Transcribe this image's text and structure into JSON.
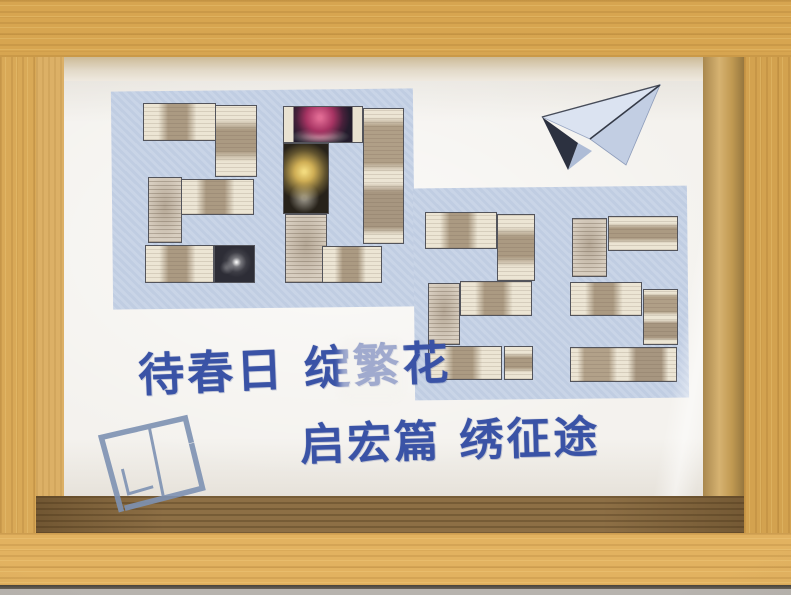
{
  "collage": {
    "year": "2025",
    "digits": [
      {
        "char": "2",
        "x": 79,
        "y": 22,
        "w": 114,
        "h": 180,
        "blocks": [
          {
            "x": 0,
            "y": 0,
            "w": 64,
            "h": 21,
            "t": "pv"
          },
          {
            "x": 63,
            "y": 1,
            "w": 37,
            "h": 40,
            "t": "ph"
          },
          {
            "x": 33,
            "y": 42,
            "w": 64,
            "h": 20,
            "t": "pv"
          },
          {
            "x": 4,
            "y": 41,
            "w": 30,
            "h": 37,
            "t": "ptxt"
          },
          {
            "x": 2,
            "y": 79,
            "w": 60,
            "h": 21,
            "t": "pv"
          },
          {
            "x": 62,
            "y": 79,
            "w": 36,
            "h": 21,
            "t": "fww"
          }
        ]
      },
      {
        "char": "0",
        "x": 219,
        "y": 25,
        "w": 121,
        "h": 177,
        "blocks": [
          {
            "x": 0,
            "y": 0,
            "w": 66,
            "h": 21,
            "t": "fwp"
          },
          {
            "x": 66,
            "y": 1,
            "w": 34,
            "h": 77,
            "t": "ph2"
          },
          {
            "x": 0,
            "y": 21,
            "w": 38,
            "h": 40,
            "t": "fwg"
          },
          {
            "x": 2,
            "y": 61,
            "w": 34,
            "h": 39,
            "t": "ptxt"
          },
          {
            "x": 32,
            "y": 79,
            "w": 50,
            "h": 21,
            "t": "pv"
          }
        ]
      },
      {
        "char": "2",
        "x": 361,
        "y": 131,
        "w": 110,
        "h": 168,
        "blocks": [
          {
            "x": 0,
            "y": 0,
            "w": 65,
            "h": 22,
            "t": "pv"
          },
          {
            "x": 65,
            "y": 1,
            "w": 35,
            "h": 40,
            "t": "ph"
          },
          {
            "x": 32,
            "y": 41,
            "w": 65,
            "h": 21,
            "t": "pv"
          },
          {
            "x": 3,
            "y": 42,
            "w": 29,
            "h": 37,
            "t": "ptxt"
          },
          {
            "x": 3,
            "y": 80,
            "w": 67,
            "h": 20,
            "t": "pv"
          },
          {
            "x": 72,
            "y": 80,
            "w": 26,
            "h": 20,
            "t": "ph"
          }
        ]
      },
      {
        "char": "5",
        "x": 506,
        "y": 135,
        "w": 108,
        "h": 166,
        "blocks": [
          {
            "x": 2,
            "y": 1,
            "w": 32,
            "h": 36,
            "t": "ptxt"
          },
          {
            "x": 35,
            "y": 0,
            "w": 65,
            "h": 21,
            "t": "ph"
          },
          {
            "x": 0,
            "y": 40,
            "w": 67,
            "h": 20,
            "t": "pv"
          },
          {
            "x": 68,
            "y": 44,
            "w": 32,
            "h": 34,
            "t": "ph2"
          },
          {
            "x": 0,
            "y": 79,
            "w": 99,
            "h": 21,
            "t": "pv2"
          }
        ]
      }
    ]
  },
  "calligraphy": {
    "line1": "待春日 绽繁花",
    "line2": "启宏篇 绣征途"
  },
  "icons": {
    "paper_airplane": "paper-airplane-icon",
    "book_sketch": "book-sketch-icon"
  },
  "colors": {
    "frame_wood": "#dcab57",
    "inner_shelf": "#8d6f45",
    "mat_white": "#f4f2ee",
    "panel_blue": "#c6d2e6",
    "tile_paper": "#ebe4d3",
    "tile_print": "#ab9a82",
    "ink_blue": "#3a53a6",
    "airplane_blue": "#dbe3f1",
    "sketch_blue": "#7e92b3",
    "firework_pink": "#e06a93",
    "firework_gold": "#f2da7e",
    "firework_white": "#f0efe8"
  }
}
